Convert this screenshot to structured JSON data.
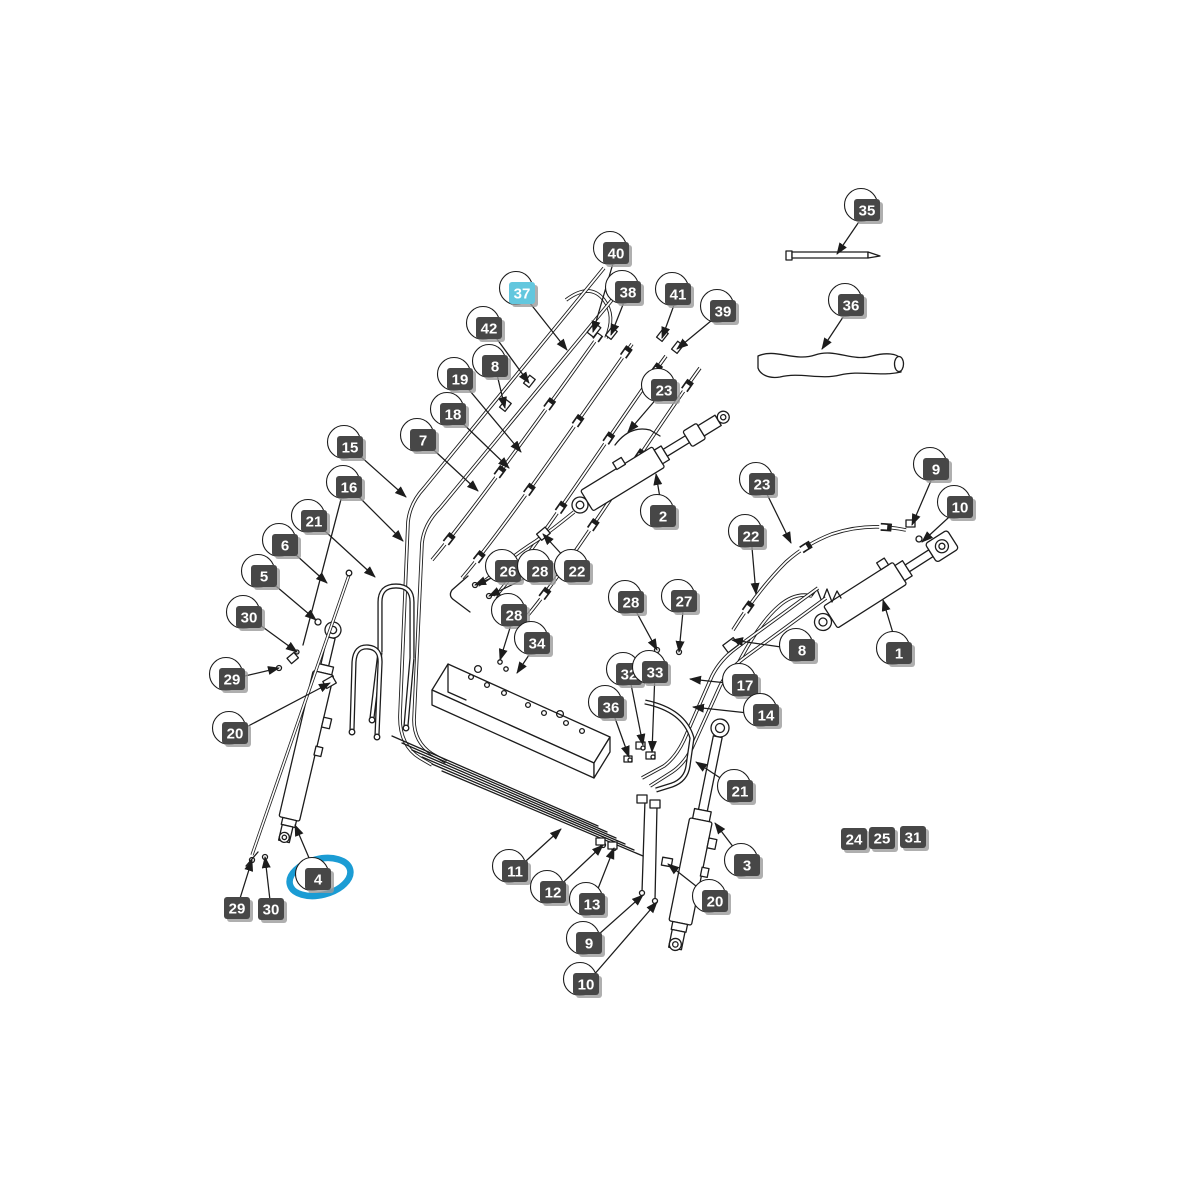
{
  "colors": {
    "background": "#ffffff",
    "line": "#1c1c1c",
    "label_bg": "#474747",
    "label_text": "#ffffff",
    "highlight_label_bg": "#63c7de",
    "highlight_ellipse": "#1b9cd4",
    "shadow": "#9b9b9b"
  },
  "callouts": [
    {
      "n": "40",
      "x": 616,
      "y": 253,
      "tx": 593,
      "ty": 332
    },
    {
      "n": "37",
      "x": 522,
      "y": 293,
      "tx": 567,
      "ty": 350,
      "style": "highlight"
    },
    {
      "n": "38",
      "x": 628,
      "y": 292,
      "tx": 611,
      "ty": 335
    },
    {
      "n": "41",
      "x": 678,
      "y": 294,
      "tx": 662,
      "ty": 338
    },
    {
      "n": "39",
      "x": 723,
      "y": 311,
      "tx": 677,
      "ty": 349
    },
    {
      "n": "42",
      "x": 489,
      "y": 328,
      "tx": 529,
      "ty": 383
    },
    {
      "n": "8",
      "x": 495,
      "y": 366,
      "tx": 505,
      "ty": 408
    },
    {
      "n": "19",
      "x": 460,
      "y": 379,
      "tx": 521,
      "ty": 452
    },
    {
      "n": "18",
      "x": 453,
      "y": 414,
      "tx": 509,
      "ty": 468
    },
    {
      "n": "23",
      "x": 664,
      "y": 390,
      "tx": 628,
      "ty": 432
    },
    {
      "n": "7",
      "x": 423,
      "y": 440,
      "tx": 478,
      "ty": 491
    },
    {
      "n": "15",
      "x": 350,
      "y": 447,
      "tx": 406,
      "ty": 497
    },
    {
      "n": "16",
      "x": 349,
      "y": 487,
      "tx": 403,
      "ty": 541
    },
    {
      "n": "35",
      "x": 867,
      "y": 210,
      "tx": 837,
      "ty": 254
    },
    {
      "n": "36",
      "x": 851,
      "y": 305,
      "tx": 822,
      "ty": 349
    },
    {
      "n": "21",
      "x": 314,
      "y": 521,
      "tx": 375,
      "ty": 577
    },
    {
      "n": "6",
      "x": 285,
      "y": 545,
      "tx": 327,
      "ty": 583
    },
    {
      "n": "5",
      "x": 264,
      "y": 576,
      "tx": 316,
      "ty": 620
    },
    {
      "n": "30",
      "x": 249,
      "y": 617,
      "tx": 297,
      "ty": 652
    },
    {
      "n": "29",
      "x": 232,
      "y": 679,
      "tx": 279,
      "ty": 668
    },
    {
      "n": "20",
      "x": 235,
      "y": 733,
      "tx": 330,
      "ty": 683
    },
    {
      "n": "2",
      "x": 663,
      "y": 516,
      "tx": 656,
      "ty": 474
    },
    {
      "n": "26",
      "x": 508,
      "y": 571,
      "tx": 475,
      "ty": 585
    },
    {
      "n": "28",
      "x": 540,
      "y": 571,
      "tx": 489,
      "ty": 596
    },
    {
      "n": "22",
      "x": 577,
      "y": 571,
      "tx": 543,
      "ty": 534
    },
    {
      "n": "23",
      "x": 762,
      "y": 484,
      "tx": 791,
      "ty": 543
    },
    {
      "n": "22",
      "x": 751,
      "y": 536,
      "tx": 756,
      "ty": 594
    },
    {
      "n": "9",
      "x": 936,
      "y": 469,
      "tx": 912,
      "ty": 525
    },
    {
      "n": "10",
      "x": 960,
      "y": 507,
      "tx": 922,
      "ty": 542
    },
    {
      "n": "8",
      "x": 802,
      "y": 650,
      "tx": 732,
      "ty": 640
    },
    {
      "n": "1",
      "x": 899,
      "y": 653,
      "tx": 883,
      "ty": 600
    },
    {
      "n": "28",
      "x": 514,
      "y": 615,
      "tx": 500,
      "ty": 660
    },
    {
      "n": "34",
      "x": 537,
      "y": 643,
      "tx": 517,
      "ty": 673
    },
    {
      "n": "28",
      "x": 631,
      "y": 602,
      "tx": 657,
      "ty": 650
    },
    {
      "n": "27",
      "x": 684,
      "y": 601,
      "tx": 679,
      "ty": 652
    },
    {
      "n": "32",
      "x": 629,
      "y": 674,
      "tx": 643,
      "ty": 745
    },
    {
      "n": "33",
      "x": 655,
      "y": 672,
      "tx": 652,
      "ty": 752
    },
    {
      "n": "36",
      "x": 611,
      "y": 707,
      "tx": 629,
      "ty": 757
    },
    {
      "n": "17",
      "x": 745,
      "y": 685,
      "tx": 690,
      "ty": 679
    },
    {
      "n": "14",
      "x": 766,
      "y": 715,
      "tx": 693,
      "ty": 707
    },
    {
      "n": "21",
      "x": 740,
      "y": 791,
      "tx": 696,
      "ty": 762
    },
    {
      "n": "3",
      "x": 747,
      "y": 865,
      "tx": 715,
      "ty": 823
    },
    {
      "n": "20",
      "x": 715,
      "y": 901,
      "tx": 668,
      "ty": 864
    },
    {
      "n": "24",
      "x": 854,
      "y": 839,
      "style": "plain"
    },
    {
      "n": "25",
      "x": 882,
      "y": 838,
      "style": "plain"
    },
    {
      "n": "31",
      "x": 913,
      "y": 837,
      "style": "plain"
    },
    {
      "n": "11",
      "x": 515,
      "y": 871,
      "tx": 561,
      "ty": 829
    },
    {
      "n": "12",
      "x": 553,
      "y": 892,
      "tx": 603,
      "ty": 845
    },
    {
      "n": "13",
      "x": 592,
      "y": 904,
      "tx": 614,
      "ty": 848
    },
    {
      "n": "9",
      "x": 589,
      "y": 943,
      "tx": 643,
      "ty": 895
    },
    {
      "n": "10",
      "x": 586,
      "y": 984,
      "tx": 657,
      "ty": 902
    },
    {
      "n": "4",
      "x": 318,
      "y": 879,
      "tx": 295,
      "ty": 825,
      "circled": true
    },
    {
      "n": "29",
      "x": 237,
      "y": 908,
      "tx": 252,
      "ty": 860,
      "style": "plain"
    },
    {
      "n": "30",
      "x": 271,
      "y": 909,
      "tx": 265,
      "ty": 857,
      "style": "plain"
    }
  ]
}
